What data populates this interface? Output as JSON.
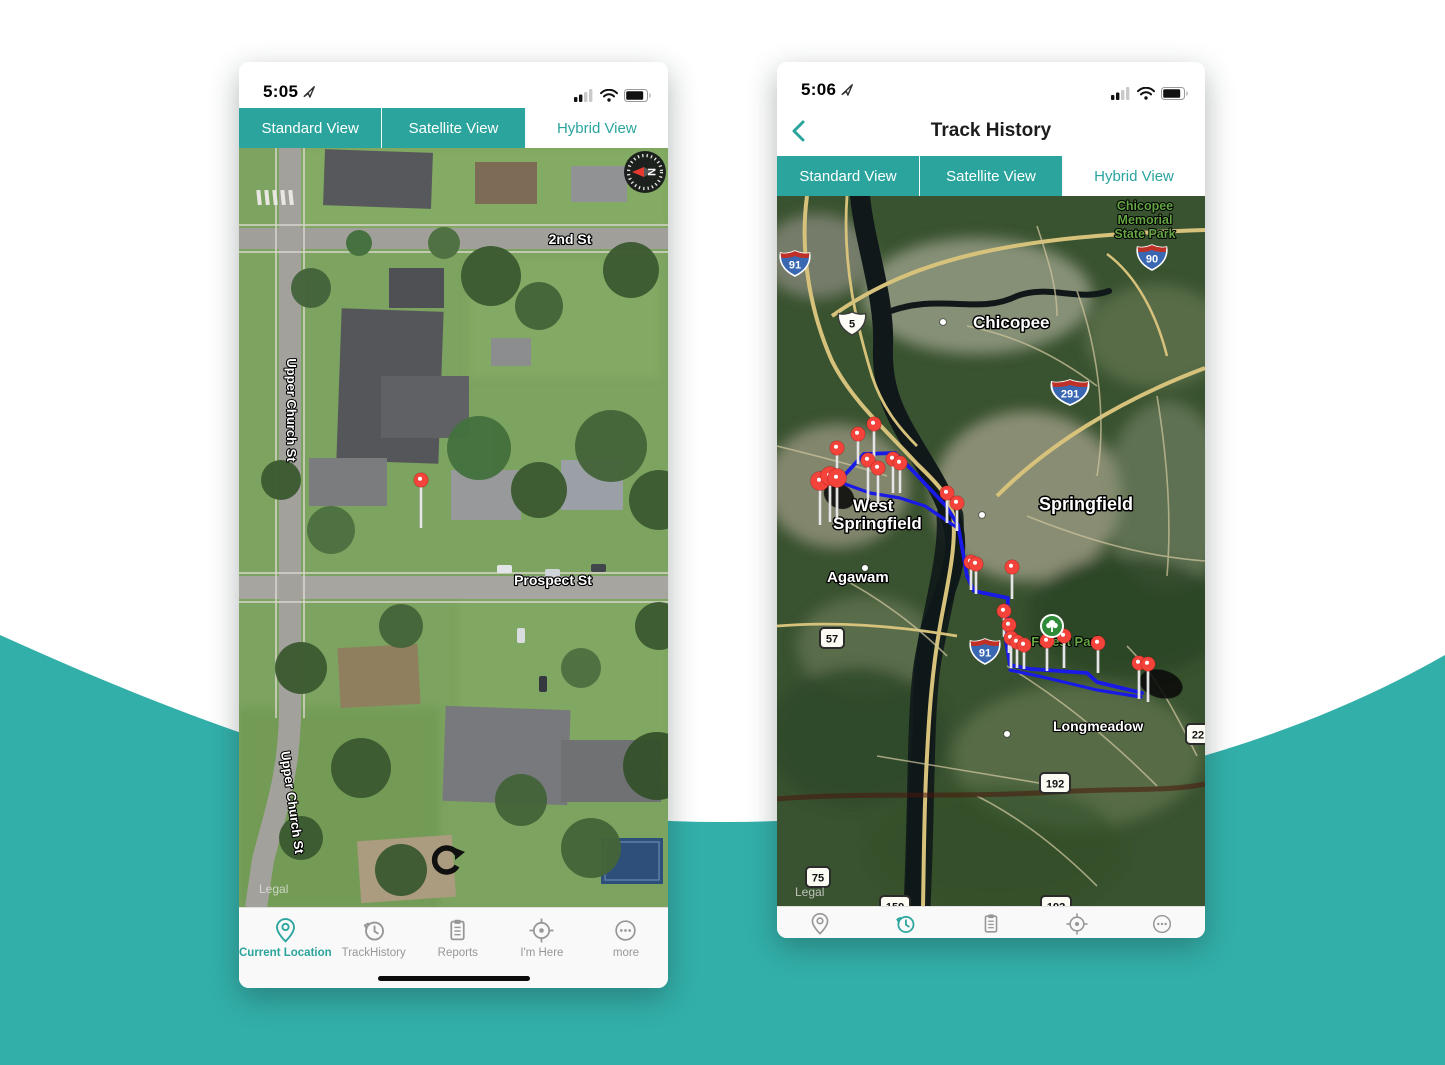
{
  "background": {
    "swoosh_color": "#33AFA9"
  },
  "theme": {
    "teal": "#2AA49D",
    "route_blue": "#1A1AE6",
    "pin_red": "#F4433B"
  },
  "left_phone": {
    "status": {
      "time": "5:05"
    },
    "tabs": [
      {
        "label": "Standard View",
        "active": false
      },
      {
        "label": "Satellite View",
        "active": false
      },
      {
        "label": "Hybrid View",
        "active": true
      }
    ],
    "map": {
      "street_labels": [
        {
          "text": "2nd St",
          "x": 331,
          "y": 96,
          "rot": 0,
          "size": 14
        },
        {
          "text": "Upper Church St",
          "x": 48,
          "y": 262,
          "rot": 90,
          "size": 13
        },
        {
          "text": "Prospect St",
          "x": 314,
          "y": 437,
          "rot": 0,
          "size": 14
        },
        {
          "text": "Upper Church St",
          "x": 49,
          "y": 655,
          "rot": 82,
          "size": 13
        }
      ],
      "legal": "Legal",
      "pin": {
        "x": 182,
        "y": 332,
        "stem": 48
      },
      "compass": {
        "x": 406,
        "y": 24,
        "label": "N"
      }
    },
    "nav": [
      {
        "label": "Current Location",
        "icon": "location-pin",
        "active": true
      },
      {
        "label": "TrackHistory",
        "icon": "history",
        "active": false
      },
      {
        "label": "Reports",
        "icon": "reports",
        "active": false
      },
      {
        "label": "I'm Here",
        "icon": "target",
        "active": false
      },
      {
        "label": "more",
        "icon": "more",
        "active": false
      }
    ]
  },
  "right_phone": {
    "status": {
      "time": "5:06"
    },
    "header": {
      "title": "Track History"
    },
    "tabs": [
      {
        "label": "Standard View",
        "active": false
      },
      {
        "label": "Satellite View",
        "active": false
      },
      {
        "label": "Hybrid View",
        "active": true
      }
    ],
    "map": {
      "park_label": {
        "lines": [
          "Chicopee",
          "Memorial",
          "State Park"
        ],
        "x": 368,
        "y": 14
      },
      "forest_label": {
        "text": "Forest Park",
        "x": 290,
        "y": 450
      },
      "legal": "Legal",
      "city_labels": [
        {
          "text": "Chicopee",
          "x": 196,
          "y": 132,
          "size": 17,
          "dot": [
            166,
            126
          ]
        },
        {
          "text": "Springfield",
          "x": 262,
          "y": 314,
          "size": 18,
          "dot": [
            205,
            319
          ]
        },
        {
          "text": "West",
          "x": 76,
          "y": 315,
          "size": 17
        },
        {
          "text": "Springfield",
          "x": 56,
          "y": 333,
          "size": 17
        },
        {
          "text": "Agawam",
          "x": 50,
          "y": 386,
          "size": 15,
          "dot": [
            88,
            372
          ]
        },
        {
          "text": "Longmeadow",
          "x": 276,
          "y": 535,
          "size": 14,
          "dot": [
            230,
            538
          ]
        }
      ],
      "shields": [
        {
          "type": "interstate",
          "num": "91",
          "x": 18,
          "y": 67
        },
        {
          "type": "interstate",
          "num": "90",
          "x": 375,
          "y": 61
        },
        {
          "type": "us",
          "num": "5",
          "x": 75,
          "y": 127
        },
        {
          "type": "interstate",
          "num": "291",
          "x": 293,
          "y": 196
        },
        {
          "type": "state",
          "num": "57",
          "x": 55,
          "y": 442
        },
        {
          "type": "interstate",
          "num": "91",
          "x": 208,
          "y": 455
        },
        {
          "type": "state",
          "num": "22",
          "x": 421,
          "y": 538
        },
        {
          "type": "state",
          "num": "192",
          "x": 278,
          "y": 587
        },
        {
          "type": "state",
          "num": "75",
          "x": 41,
          "y": 681
        },
        {
          "type": "state",
          "num": "159",
          "x": 118,
          "y": 710
        },
        {
          "type": "state",
          "num": "192",
          "x": 279,
          "y": 710
        }
      ],
      "route": {
        "main": [
          [
            63,
            284
          ],
          [
            87,
            258
          ],
          [
            118,
            257
          ],
          [
            136,
            275
          ],
          [
            169,
            310
          ],
          [
            181,
            329
          ],
          [
            185,
            351
          ],
          [
            190,
            380
          ],
          [
            197,
            395
          ],
          [
            231,
            402
          ],
          [
            229,
            445
          ],
          [
            233,
            469
          ],
          [
            253,
            473
          ],
          [
            283,
            475
          ],
          [
            310,
            477
          ],
          [
            320,
            486
          ],
          [
            365,
            497
          ]
        ],
        "branch": [
          [
            68,
            288
          ],
          [
            93,
            297
          ],
          [
            123,
            302
          ],
          [
            148,
            310
          ],
          [
            173,
            327
          ],
          [
            181,
            332
          ]
        ],
        "parallel": [
          [
            233,
            474
          ],
          [
            270,
            482
          ],
          [
            320,
            494
          ],
          [
            364,
            501
          ]
        ]
      },
      "pins": [
        {
          "x": 97,
          "y": 228,
          "stem": 34
        },
        {
          "x": 81,
          "y": 238,
          "stem": 30
        },
        {
          "x": 60,
          "y": 252,
          "stem": 28
        },
        {
          "x": 91,
          "y": 264,
          "stem": 40
        },
        {
          "x": 101,
          "y": 272,
          "stem": 36
        },
        {
          "x": 116,
          "y": 263,
          "stem": 34
        },
        {
          "x": 123,
          "y": 267,
          "stem": 30
        },
        {
          "x": 43,
          "y": 285,
          "stem": 44,
          "big": true
        },
        {
          "x": 53,
          "y": 280,
          "stem": 46,
          "big": true
        },
        {
          "x": 60,
          "y": 282,
          "stem": 40,
          "big": true
        },
        {
          "x": 170,
          "y": 297,
          "stem": 30
        },
        {
          "x": 180,
          "y": 307,
          "stem": 28
        },
        {
          "x": 194,
          "y": 366,
          "stem": 28
        },
        {
          "x": 199,
          "y": 368,
          "stem": 30
        },
        {
          "x": 235,
          "y": 371,
          "stem": 32
        },
        {
          "x": 227,
          "y": 415,
          "stem": 26
        },
        {
          "x": 232,
          "y": 429,
          "stem": 28
        },
        {
          "x": 234,
          "y": 442,
          "stem": 30
        },
        {
          "x": 240,
          "y": 446,
          "stem": 26
        },
        {
          "x": 247,
          "y": 449,
          "stem": 24
        },
        {
          "x": 270,
          "y": 445,
          "stem": 30
        },
        {
          "x": 287,
          "y": 440,
          "stem": 32
        },
        {
          "x": 321,
          "y": 447,
          "stem": 30
        },
        {
          "x": 362,
          "y": 467,
          "stem": 36
        },
        {
          "x": 371,
          "y": 468,
          "stem": 38
        }
      ],
      "tree_pin": {
        "x": 275,
        "y": 430
      }
    },
    "nav": [
      {
        "icon": "location-pin",
        "active": false
      },
      {
        "icon": "history",
        "active": true
      },
      {
        "icon": "reports",
        "active": false
      },
      {
        "icon": "target",
        "active": false
      },
      {
        "icon": "more",
        "active": false
      }
    ]
  }
}
